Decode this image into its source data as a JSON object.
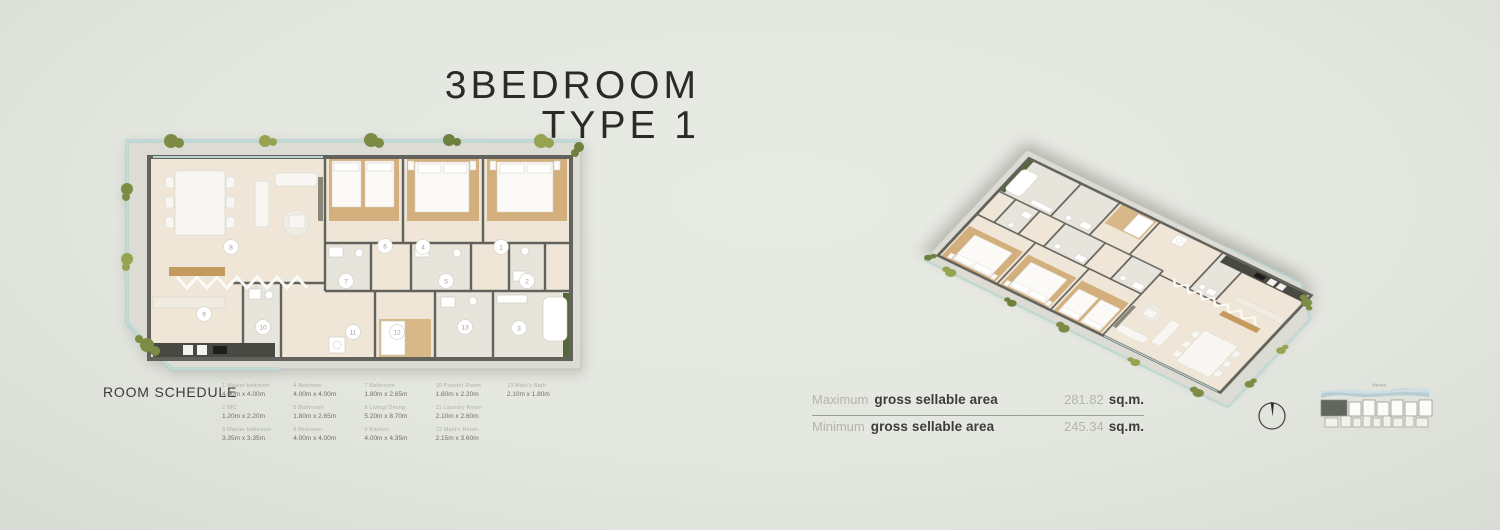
{
  "title": {
    "line1": "3BEDROOM",
    "line2": "TYPE 1"
  },
  "room_schedule": {
    "heading": "ROOM SCHEDULE",
    "columns": [
      [
        {
          "no": "1",
          "name": "Master bedroom",
          "dims": "4.00m x 4.00m"
        },
        {
          "no": "2",
          "name": "WC",
          "dims": "1.20m x 2.20m"
        },
        {
          "no": "3",
          "name": "Master bathroom",
          "dims": "3.35m x 3.35m"
        }
      ],
      [
        {
          "no": "4",
          "name": "Bedroom",
          "dims": "4.00m x 4.00m"
        },
        {
          "no": "5",
          "name": "Bathroom",
          "dims": "1.80m x 2.65m"
        },
        {
          "no": "6",
          "name": "Bedroom",
          "dims": "4.00m x 4.00m"
        }
      ],
      [
        {
          "no": "7",
          "name": "Bathroom",
          "dims": "1.80m x 2.65m"
        },
        {
          "no": "8",
          "name": "Living/ Dining",
          "dims": "5.20m x 8.70m"
        },
        {
          "no": "9",
          "name": "Kitchen",
          "dims": "4.00m x 4.35m"
        }
      ],
      [
        {
          "no": "10",
          "name": "Powder Room",
          "dims": "1.60m x 2.20m"
        },
        {
          "no": "11",
          "name": "Laundry Room",
          "dims": "2.10m x 2.60m"
        },
        {
          "no": "12",
          "name": "Maid's Room",
          "dims": "2.15m x 3.60m"
        }
      ],
      [
        {
          "no": "13",
          "name": "Maid's Bath",
          "dims": "2.10m x 1.80m"
        }
      ]
    ]
  },
  "floorplan": {
    "markers": [
      "8",
      "9",
      "10",
      "11",
      "12",
      "13",
      "3",
      "2",
      "1",
      "4",
      "5",
      "6",
      "7"
    ]
  },
  "areas": {
    "rows": [
      {
        "qualifier": "Maximum",
        "label": "gross sellable area",
        "value": "281.82",
        "unit": "sq.m."
      },
      {
        "qualifier": "Minimum",
        "label": "gross sellable area",
        "value": "245.34",
        "unit": "sq.m."
      }
    ]
  },
  "keymap": {
    "location_label": "Marina"
  },
  "icons": {
    "compass": "north-compass-icon",
    "keymap": "building-key-plan",
    "plants": "balcony-plants"
  },
  "colors": {
    "background": "#e4e7e0",
    "title_text": "#2a2b28",
    "wall": "#62625c",
    "floor": "#efe6d7",
    "wood_floor": "#d2af7c",
    "balcony_glass": "#a9cdc9",
    "plant_green": "#7c8c44",
    "muted_text": "#adb0a7",
    "dark_text": "#3c3d39",
    "keymap_water": "#b7cdd2",
    "keymap_highlight": "#63665f"
  }
}
